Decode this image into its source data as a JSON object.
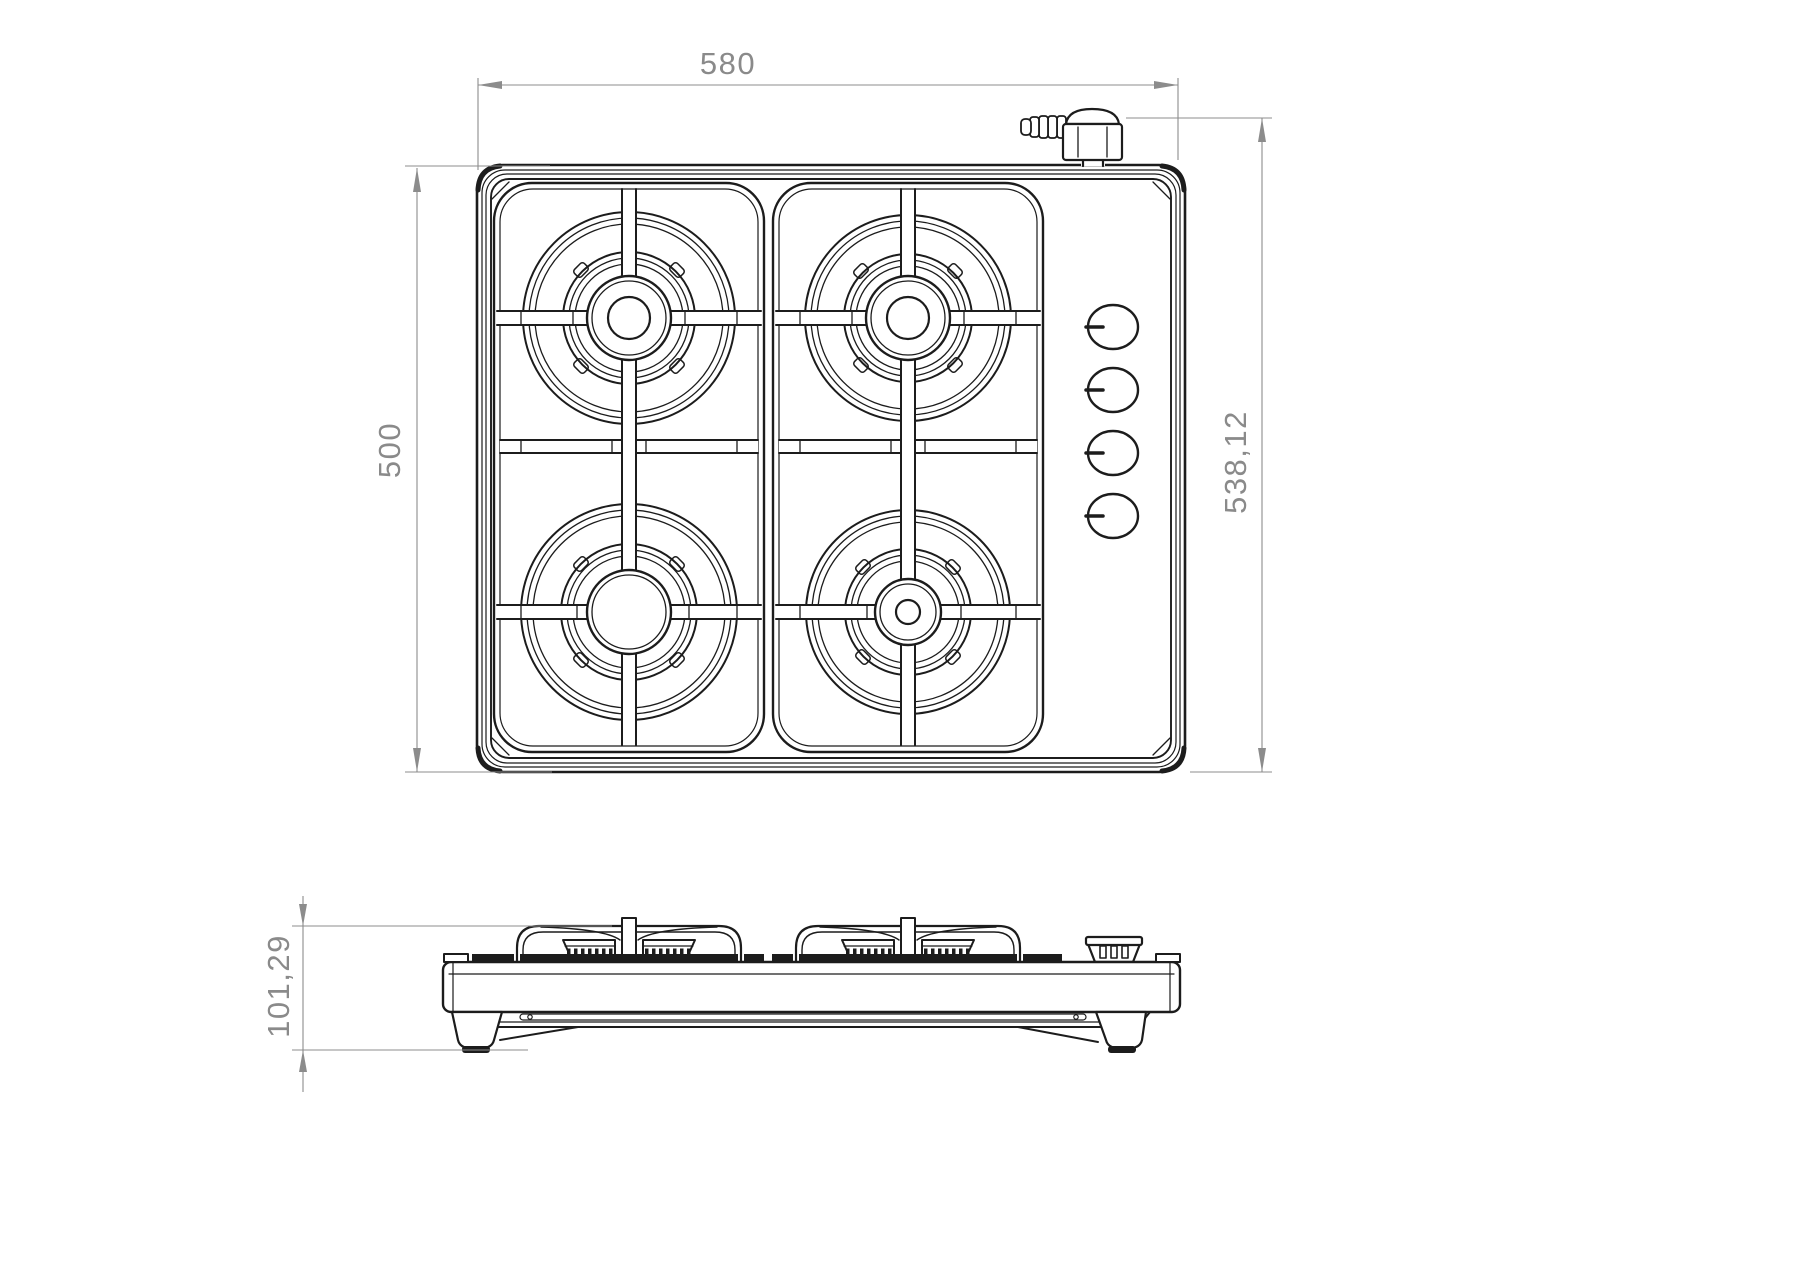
{
  "drawing": {
    "background": "#ffffff",
    "line_color": "#1c1c1c",
    "dimension_color": "#8c8c8c"
  },
  "dimensions": {
    "top_width": {
      "value": "580"
    },
    "left_depth": {
      "value": "500"
    },
    "right_total_depth": {
      "value": "538,12"
    },
    "side_height": {
      "value": "101,29"
    }
  }
}
